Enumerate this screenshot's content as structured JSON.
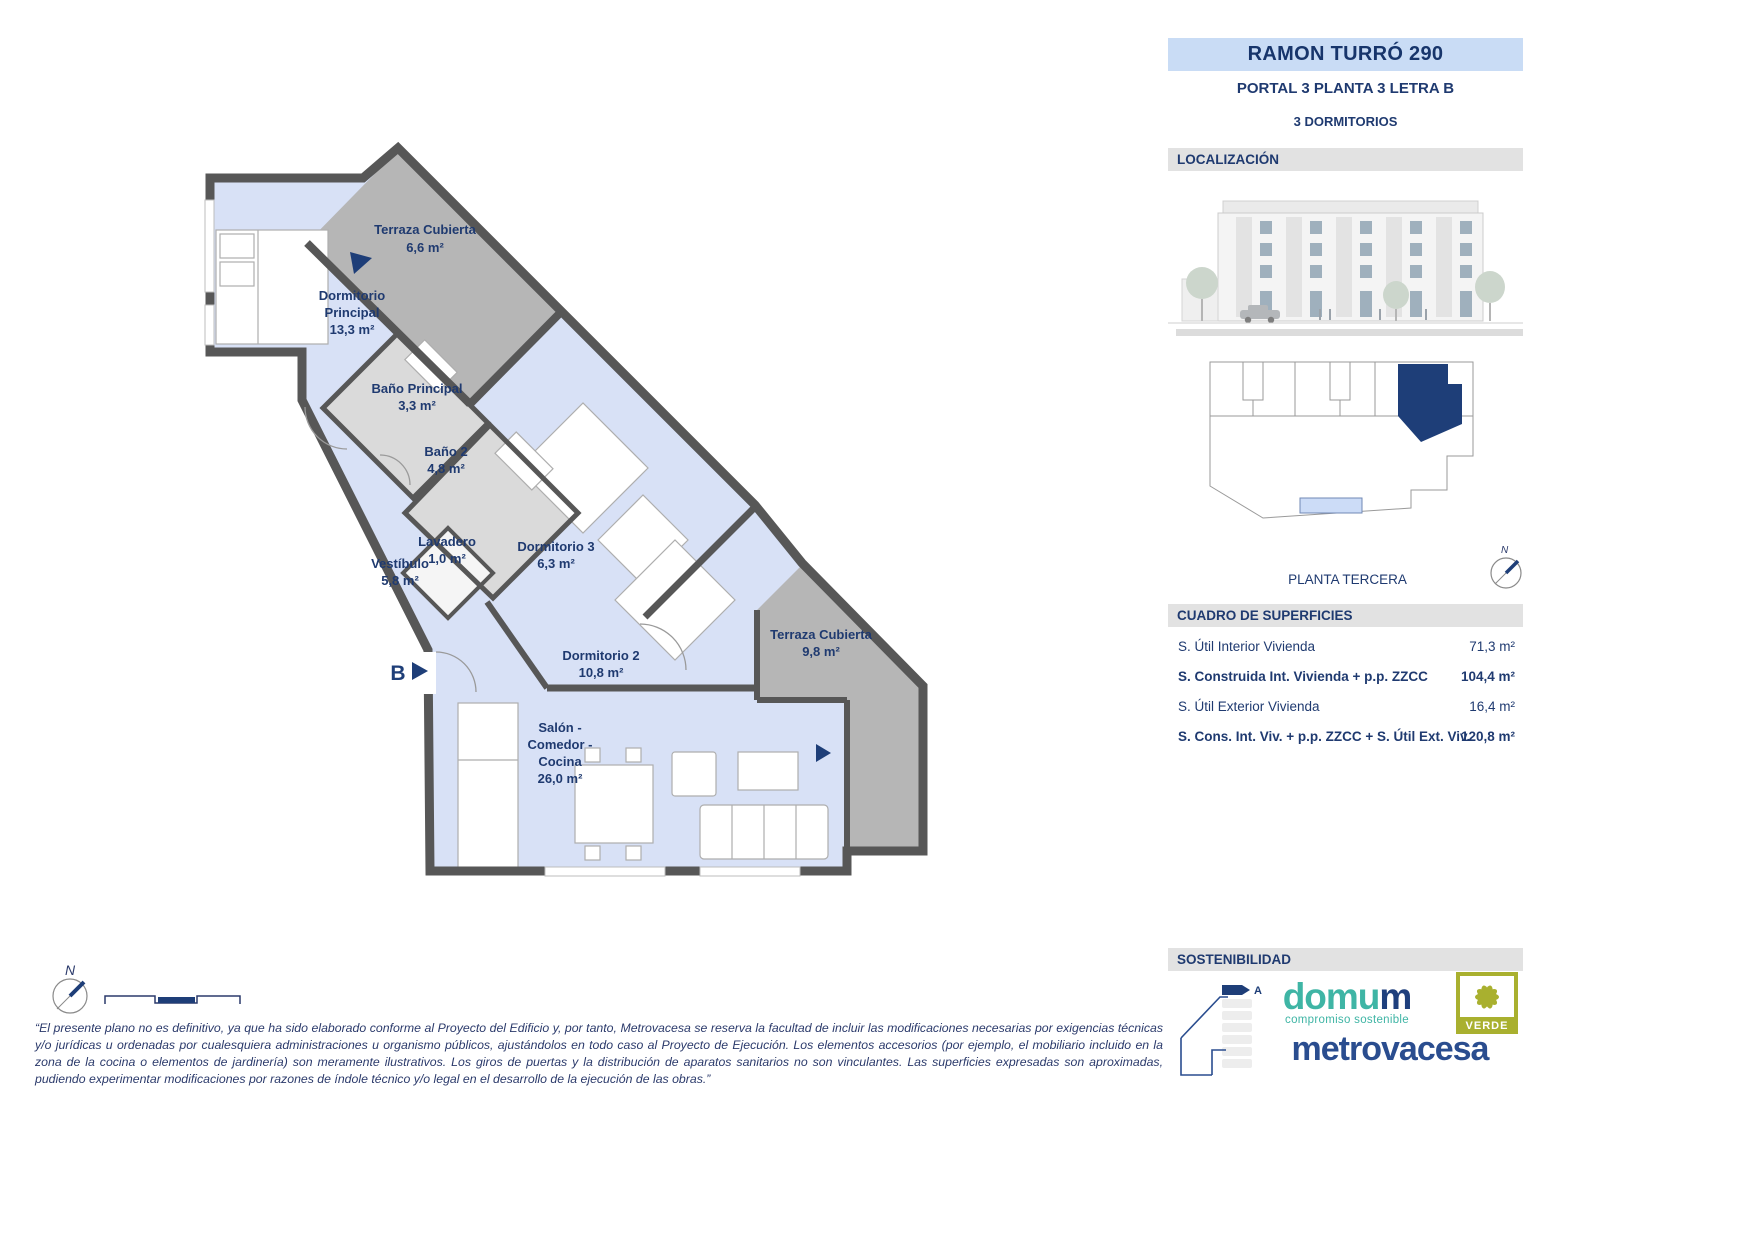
{
  "header": {
    "title": "RAMON TURRÓ 290",
    "portal_line": "PORTAL 3 PLANTA 3 LETRA B",
    "bedrooms_line": "3 DORMITORIOS"
  },
  "sections": {
    "localizacion": "LOCALIZACIÓN",
    "superficies": "CUADRO DE SUPERFICIES",
    "sostenibilidad": "SOSTENIBILIDAD"
  },
  "location": {
    "floor_label": "PLANTA TERCERA",
    "compass_north": "N"
  },
  "plan": {
    "entrance_label": "B",
    "compass_north": "N",
    "rooms": [
      {
        "id": "terraza-cubierta-1",
        "lines": [
          "Terraza Cubierta",
          "6,6 m²"
        ]
      },
      {
        "id": "dormitorio-principal",
        "lines": [
          "Dormitorio",
          "Principal",
          "13,3 m²"
        ]
      },
      {
        "id": "bano-principal",
        "lines": [
          "Baño Principal",
          "3,3 m²"
        ]
      },
      {
        "id": "bano-2",
        "lines": [
          "Baño 2",
          "4,8 m²"
        ]
      },
      {
        "id": "lavadero",
        "lines": [
          "Lavadero",
          "1,0 m²"
        ]
      },
      {
        "id": "vestibulo",
        "lines": [
          "Vestíbulo",
          "5,8 m²"
        ]
      },
      {
        "id": "dormitorio-3",
        "lines": [
          "Dormitorio 3",
          "6,3 m²"
        ]
      },
      {
        "id": "dormitorio-2",
        "lines": [
          "Dormitorio 2",
          "10,8 m²"
        ]
      },
      {
        "id": "terraza-cubierta-2",
        "lines": [
          "Terraza Cubierta",
          "9,8 m²"
        ]
      },
      {
        "id": "salon-comedor-cocina",
        "lines": [
          "Salón -",
          "Comedor -",
          "Cocina",
          "26,0 m²"
        ]
      }
    ]
  },
  "surfaces": {
    "rows": [
      {
        "label": "S. Útil Interior Vivienda",
        "value": "71,3 m²"
      },
      {
        "label": "S. Construida Int. Vivienda + p.p. ZZCC",
        "value": "104,4 m²"
      },
      {
        "label": "S. Útil Exterior Vivienda",
        "value": "16,4 m²"
      },
      {
        "label": "S. Cons. Int. Viv. + p.p. ZZCC + S. Útil Ext. Viv.",
        "value": "120,8 m²"
      }
    ]
  },
  "sustainability": {
    "rating_letter": "A",
    "domum_part1": "domu",
    "domum_part2": "m",
    "domum_tagline": "compromiso sostenible",
    "metrovacesa": "metrovacesa",
    "verde_label": "VERDE"
  },
  "disclaimer": "“El presente plano no es definitivo, ya que ha sido elaborado conforme al Proyecto del Edificio y, por tanto, Metrovacesa se reserva la facultad de incluir las modificaciones necesarias por exigencias técnicas y/o jurídicas u ordenadas por cualesquiera administraciones u organismo públicos, ajustándolos en todo caso al Proyecto de Ejecución. Los elementos accesorios (por ejemplo, el mobiliario incluido en la zona de la cocina o elementos de jardinería) son meramente ilustrativos. Los giros de puertas y la distribución de aparatos sanitarios no son vinculantes. Las superficies expresadas son aproximadas, pudiendo experimentar modificaciones por razones de índole técnico y/o legal en el desarrollo de la ejecución de las obras.”",
  "colors": {
    "navy": "#1f3a70",
    "title_bg": "#c9dcf5",
    "section_bg": "#e2e2e2",
    "plan_room_blue": "#d8e1f6",
    "plan_bath_gray": "#dadada",
    "plan_terrace_gray": "#b6b6b6",
    "wall_gray": "#575757",
    "domum_teal": "#3fb5a5",
    "metrovacesa_navy": "#2a4d8f",
    "verde_olive": "#a9b02f",
    "highlight_unit_navy": "#1e3e78"
  }
}
